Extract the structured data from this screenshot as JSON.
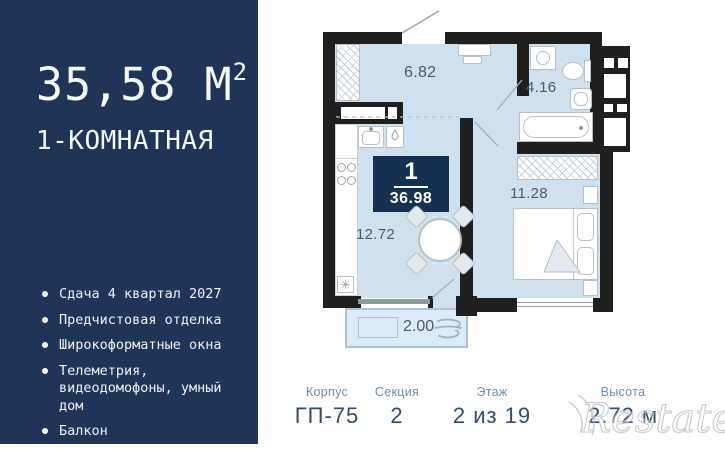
{
  "sidebar": {
    "area_value": "35,58 М",
    "area_sup": "2",
    "apartment_type": "1-КОМНАТНАЯ",
    "features": [
      "Сдача 4 квартал 2027",
      "Предчистовая отделка",
      "Широкоформатные окна",
      "Телеметрия, видеодомофоны, умный дом",
      "Балкон"
    ]
  },
  "plan": {
    "badge": {
      "room_count": "1",
      "total_area": "36.98"
    },
    "room_areas": {
      "hallway": "6.82",
      "bathroom": "4.16",
      "bedroom": "11.28",
      "kitchen_living": "12.72",
      "balcony": "2.00"
    }
  },
  "info_bar": {
    "items": [
      {
        "label": "Корпус",
        "value": "ГП-75"
      },
      {
        "label": "Секция",
        "value": "2"
      },
      {
        "label": "Этаж",
        "value": "2 из 19"
      },
      {
        "label": "Высота",
        "value": "2.72 м"
      }
    ]
  },
  "watermark": "Restate",
  "colors": {
    "sidebar_navy": "#203457",
    "badge_navy": "#16304f",
    "room_fill": "#cfe1ee",
    "wall_black": "#1f1f1d",
    "info_label_blue": "#6f8dab",
    "info_value_navy": "#2f4d6e"
  }
}
